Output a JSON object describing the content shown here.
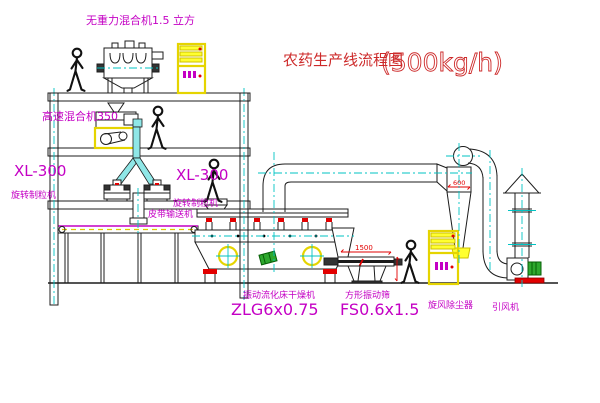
{
  "title": {
    "text": "农药生产线流程图",
    "capacity": "(500kg/h)"
  },
  "equipment": {
    "gravity_mixer": {
      "label": "无重力混合机1.5 立方"
    },
    "high_speed_mixer": {
      "label": "高速混合机350"
    },
    "granulator_left": {
      "model": "XL-300",
      "name": "旋转制粒机"
    },
    "granulator_right": {
      "model": "XL-300",
      "name": "旋转制粒机"
    },
    "belt_conveyor": {
      "name": "皮带输送机"
    },
    "dryer": {
      "name": "振动流化床干燥机",
      "model": "ZLG6x0.75"
    },
    "screen": {
      "name": "方形振动筛",
      "model": "FS0.6x1.5",
      "dim_width": "1500"
    },
    "cyclone": {
      "name": "旋风除尘器",
      "dim_dia": "600"
    },
    "fan": {
      "name": "引风机"
    }
  },
  "colors": {
    "label": "#c400c4",
    "title": "#cd2a2a",
    "centerline": "#00c3c3",
    "highlight": "#ffff00",
    "accent": "#e20000"
  }
}
